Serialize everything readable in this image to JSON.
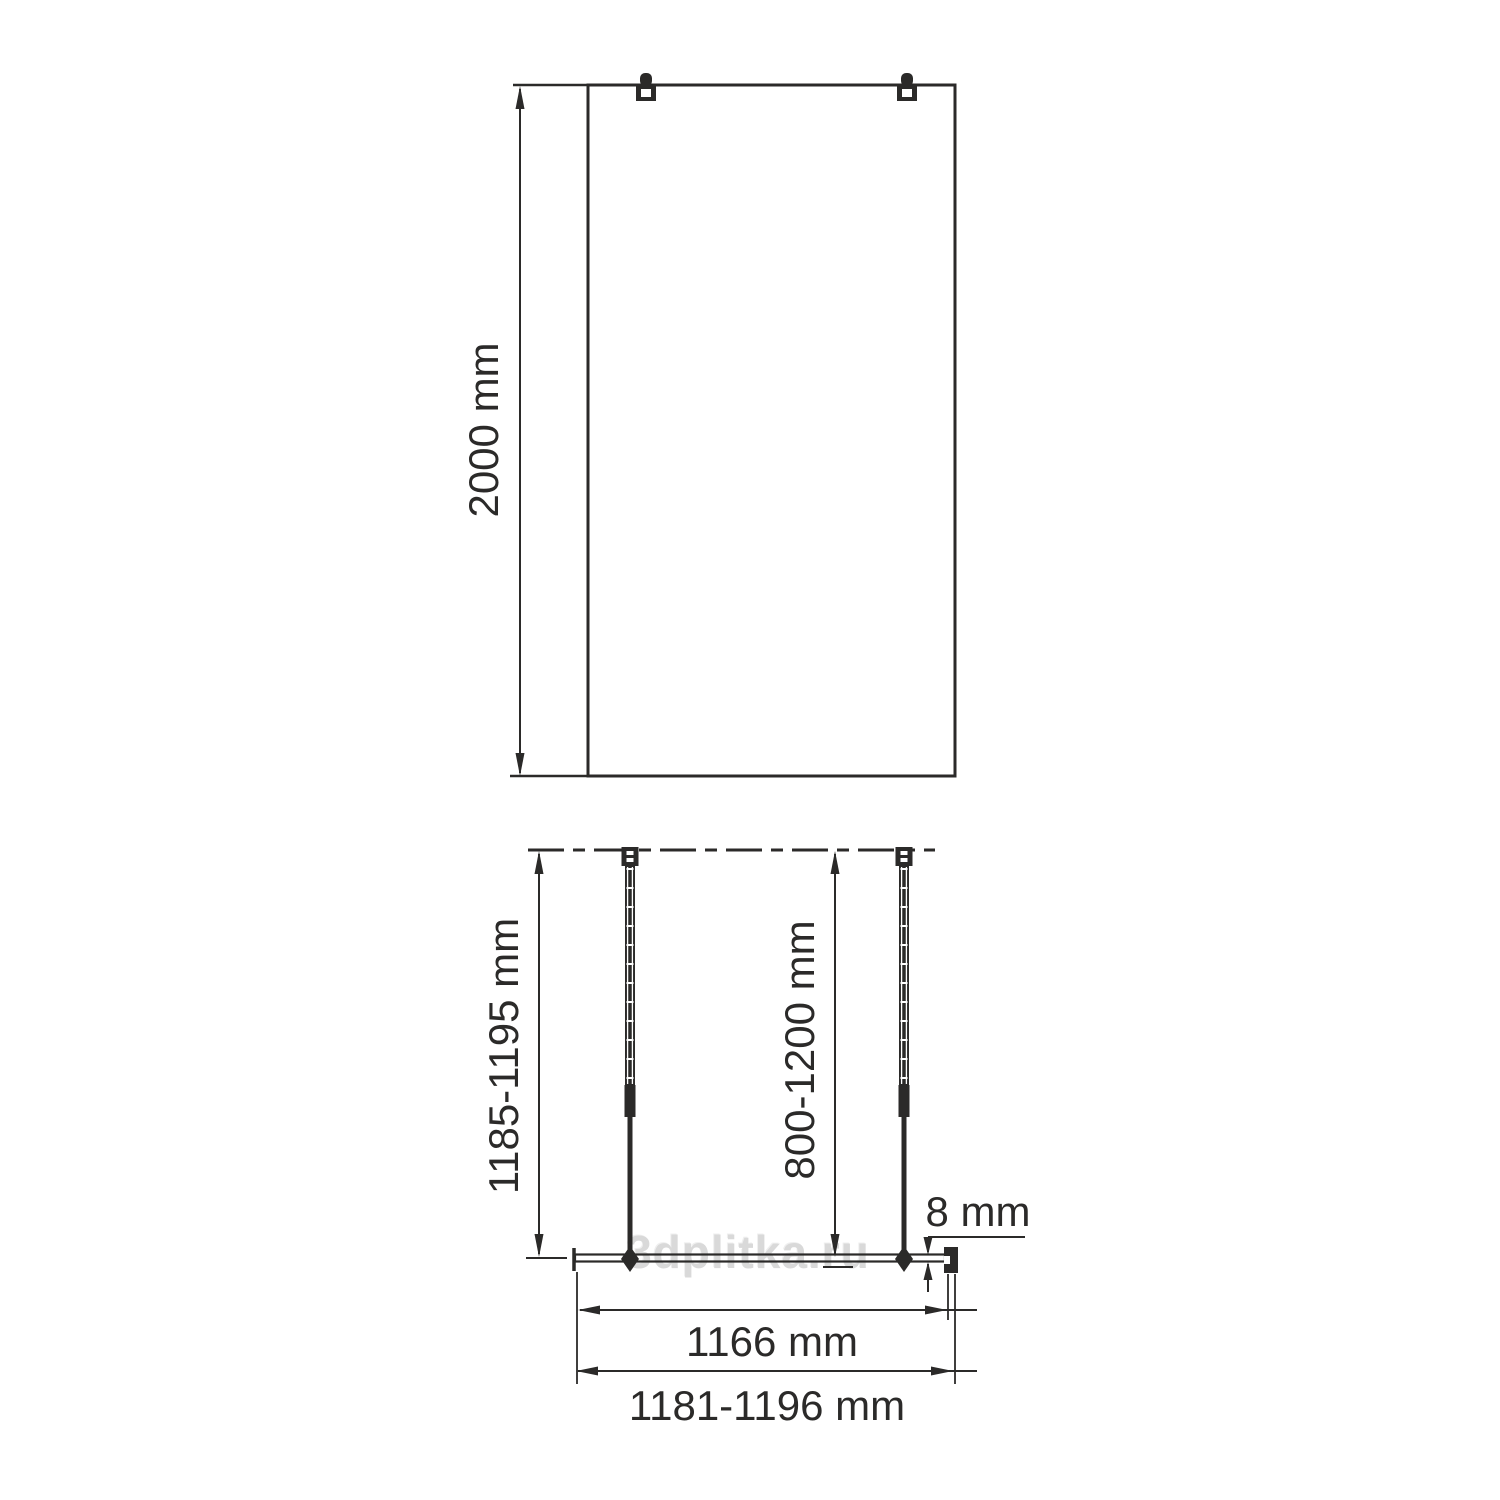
{
  "colors": {
    "line": "#2b2a29",
    "background": "#ffffff",
    "watermark_text": "#d8d8d8"
  },
  "front_view": {
    "height_label": "2000 mm"
  },
  "plan_view": {
    "bar_span_label": "1185-1195 mm",
    "bar_adjust_label": "800-1200 mm",
    "glass_thickness_label": "8 mm",
    "glass_width_label": "1166 mm",
    "overall_width_label": "1181-1196 mm"
  },
  "watermark": {
    "text": "3dplitka.ru"
  }
}
